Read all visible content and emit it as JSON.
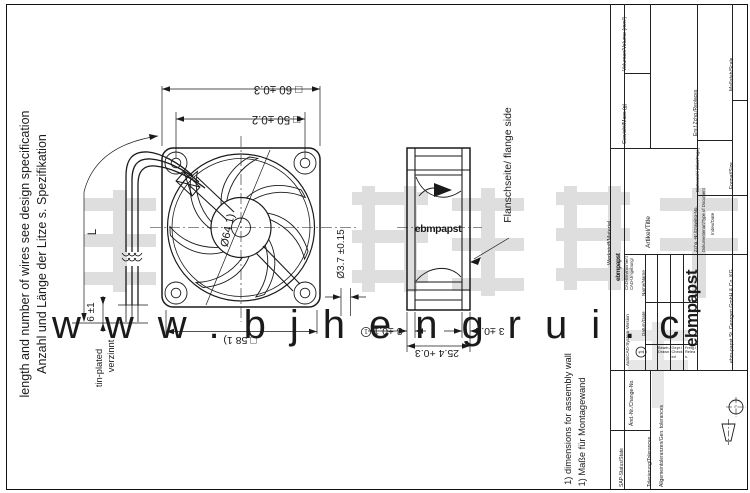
{
  "sheet": {
    "watermark_url": "www.bjhengrui.c",
    "watermark_color": "#dcdcdc"
  },
  "notes": {
    "wire_spec_en": "length and number of wires see design specification",
    "wire_spec_de": "Anzahl und Länge der Litze s. Spezifikation",
    "tin_en": "tin-plated",
    "tin_de": "verzinnt",
    "footnote_en": "1) dimensions for assembly wall",
    "footnote_de": "1) Maße für Montagewand",
    "flange_side": "Flanschseite/ flange side",
    "balloon_index": "1"
  },
  "dimensions": {
    "frame_outer": "□ 60 ±0.3",
    "hole_pitch": "□ 50 ±0.2",
    "frame_inner": "□ 58 1)",
    "impeller_dia": "Ø64 1)",
    "mount_hole_dia": "Ø3.7 ±0.15",
    "depth": "25.4 +0.3",
    "flange_left": "3 ±0.1",
    "flange_right": "3 ±0.1",
    "wire_length": "L",
    "tinned_length": "6 ±1"
  },
  "side_view": {
    "logo": "ebmpapst"
  },
  "title_block": {
    "labels": {
      "volume": "Volumen/Volume (mm³)",
      "mass": "Gewicht/Mass (g)",
      "material": "Werkstoff/Material",
      "title": "Artikel/Title",
      "replaces": "Ers.f.Zchg./Replaces",
      "scale": "Maßstab/Scale",
      "format": "Format/Size",
      "pages": "Blattanzahl (Blatt/Page)",
      "drawing_no": "Zchg.-Nr./Drawing-No.",
      "index_date": "Index/Date",
      "doc_type": "Dokumentenart/Type of Document",
      "cad_env_de": "CAD-Umgebung/",
      "cad_env_en": "CAD-Environment",
      "cad_version": "AutoCAD-System-Version",
      "date": "Datum/Date",
      "name": "Name/Name",
      "drawn": "Bearb./Drawn",
      "checked": "Gepr./Checked",
      "released": "Freig./Releas.",
      "change_no": "Änd.-Nr./Change-No.",
      "sap_status": "SAP-Status/State",
      "tolerances": "Tolerierung/Tolerances",
      "gen_tolerances": "Allgemeintoleranzen/Gen. tolerances"
    },
    "logo_small": "ebmpapst",
    "logo_large": "ebmpapst",
    "company": "ebm-papst St. Georgen GmbH & Co. KG"
  }
}
